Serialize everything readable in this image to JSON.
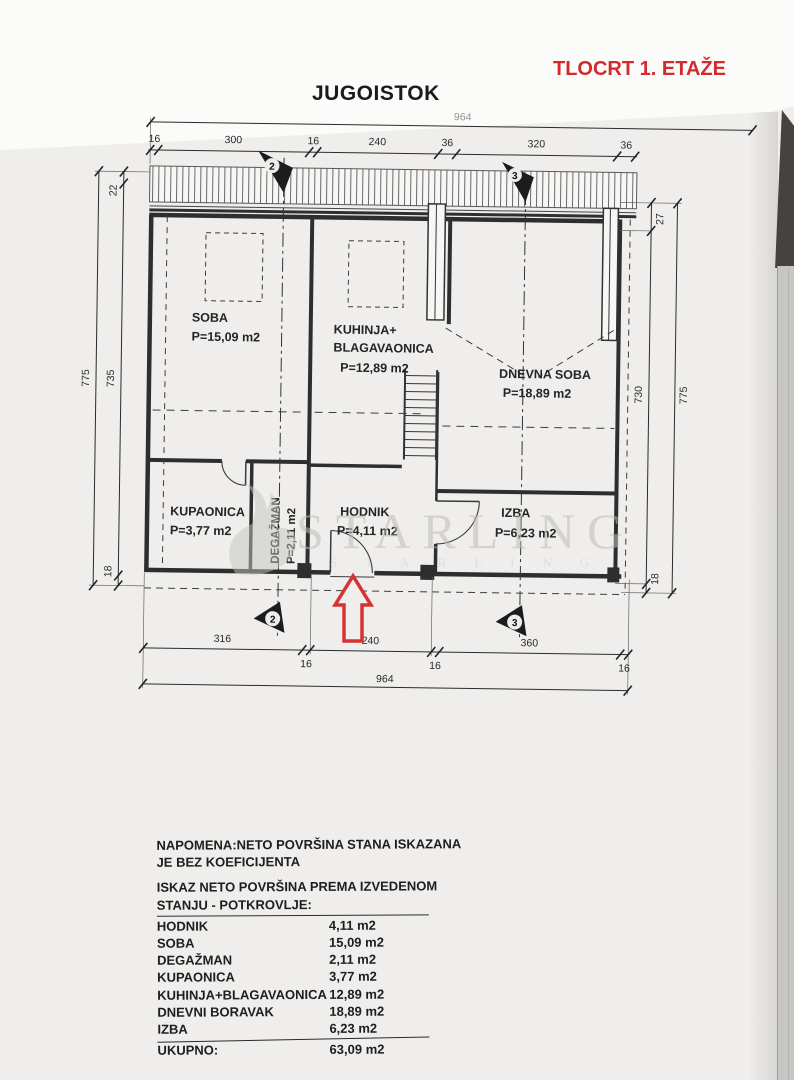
{
  "header": {
    "direction_title": "JUGOISTOK",
    "plan_title": "TLOCRT 1. ETAŽE"
  },
  "colors": {
    "plan_title_red": "#d42a2e",
    "entrance_arrow": "#d63434",
    "paper": "#efeeec",
    "line_ink": "#2b2b2b",
    "watermark_gray": "#bdbcb9"
  },
  "plan": {
    "rooms": {
      "soba": {
        "name": "SOBA",
        "area": "P=15,09 m2"
      },
      "kuhinja": {
        "name1": "KUHINJA+",
        "name2": "BLAGAVAONICA",
        "area": "P=12,89 m2"
      },
      "dnevna": {
        "name": "DNEVNA SOBA",
        "area": "P=18,89 m2"
      },
      "kupaonica": {
        "name": "KUPAONICA",
        "area": "P=3,77 m2"
      },
      "degazman": {
        "name": "DEGAŽMAN",
        "area": "P=2,11 m2"
      },
      "hodnik": {
        "name": "HODNIK",
        "area": "P=4,11 m2"
      },
      "izba": {
        "name": "IZBA",
        "area": "P=6,23 m2"
      }
    },
    "section_markers": {
      "two": "2",
      "three": "3"
    },
    "dims": {
      "top_total": "964",
      "top": [
        "16",
        "300",
        "16",
        "240",
        "36",
        "320",
        "36"
      ],
      "bottom": [
        "316",
        "240",
        "360"
      ],
      "bottom_small": [
        "16",
        "16",
        "16"
      ],
      "bottom_total": "964",
      "left": {
        "outer": "775",
        "a": "22",
        "b": "735",
        "c": "18"
      },
      "right": {
        "a": "27",
        "b": "730",
        "outer": "775",
        "c": "18"
      }
    }
  },
  "watermark": {
    "brand": "STARLING"
  },
  "summary": {
    "note_line1": "NAPOMENA:NETO POVRŠINA STANA ISKAZANA",
    "note_line2": "JE BEZ KOEFICIJENTA",
    "heading_line1": "ISKAZ NETO POVRŠINA PREMA IZVEDENOM",
    "heading_line2": "STANJU - POTKROVLJE:",
    "rows": [
      {
        "label": "HODNIK",
        "value": "4,11 m2"
      },
      {
        "label": "SOBA",
        "value": "15,09 m2"
      },
      {
        "label": "DEGAŽMAN",
        "value": "2,11 m2"
      },
      {
        "label": "KUPAONICA",
        "value": "3,77 m2"
      },
      {
        "label": "KUHINJA+BLAGAVAONICA",
        "value": "12,89 m2"
      },
      {
        "label": "DNEVNI BORAVAK",
        "value": "18,89 m2"
      },
      {
        "label": "IZBA",
        "value": "6,23 m2"
      }
    ],
    "total": {
      "label": "UKUPNO:",
      "value": "63,09 m2"
    }
  }
}
